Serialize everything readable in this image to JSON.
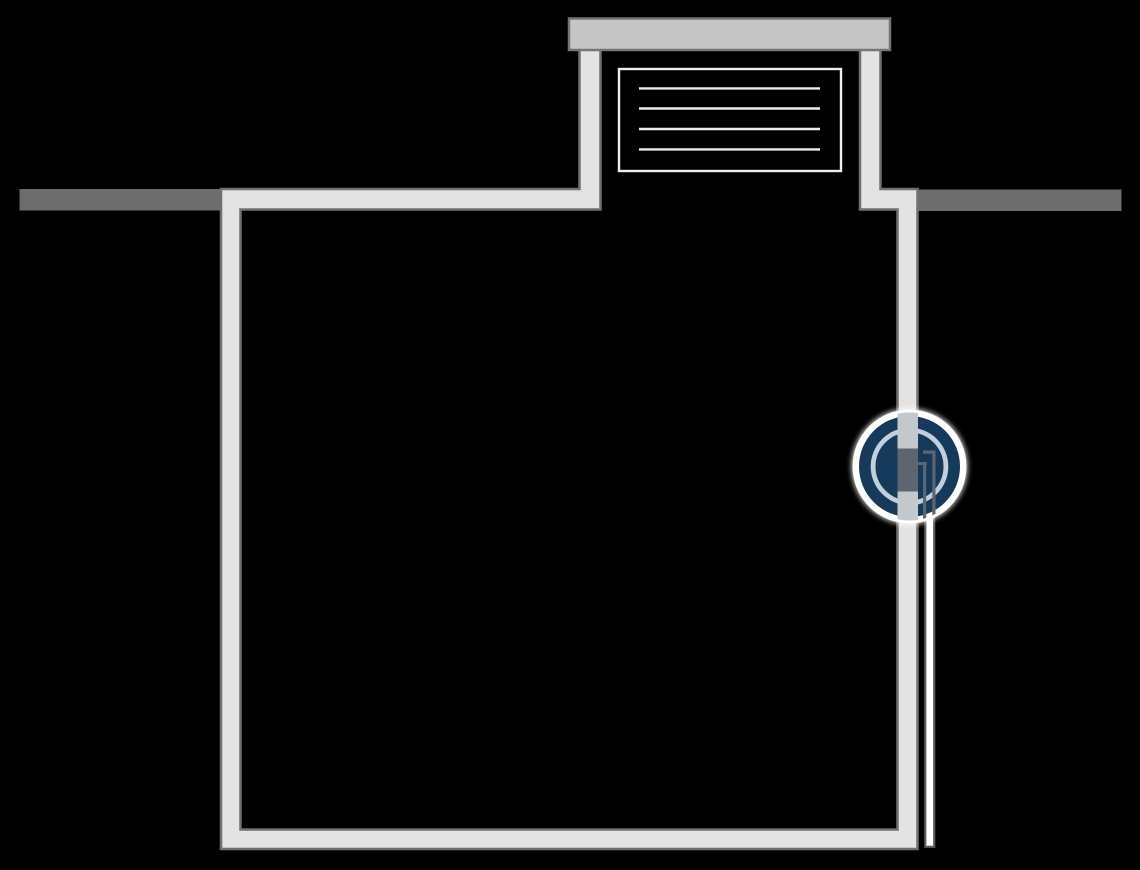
{
  "diagram": {
    "kind": "underground-tank-cross-section",
    "elements": {
      "ground_left": "ground-surface-left",
      "ground_right": "ground-surface-right",
      "tank": "tank-walls-and-floor",
      "shaft": "access-shaft-neck",
      "lid": "shaft-cover-lid",
      "grille": "vent-grille",
      "pipe": "outlet-pipe",
      "callout": "wall-penetration-detail-callout"
    }
  },
  "colors": {
    "background": "#000000",
    "ground": "#6d6d6d",
    "wall_fill": "#e3e3e3",
    "wall_border": "#6f7072",
    "lid_fill": "#c6c6c6",
    "lid_border": "#757575",
    "grille": "#ededed",
    "pipe_fill": "#ffffff",
    "pipe_border": "#5f5f5f",
    "detail_white": "#fdfdfe",
    "detail_navy": "#163a5c",
    "detail_ring_light": "#c3d0da",
    "detail_wall": "#c3c8cd",
    "detail_seal": "#5d666e"
  },
  "geometry": {
    "grille_line_count": 4,
    "callout_center": {
      "x": 909.5,
      "y": 466.5
    },
    "callout_radius": 57
  }
}
